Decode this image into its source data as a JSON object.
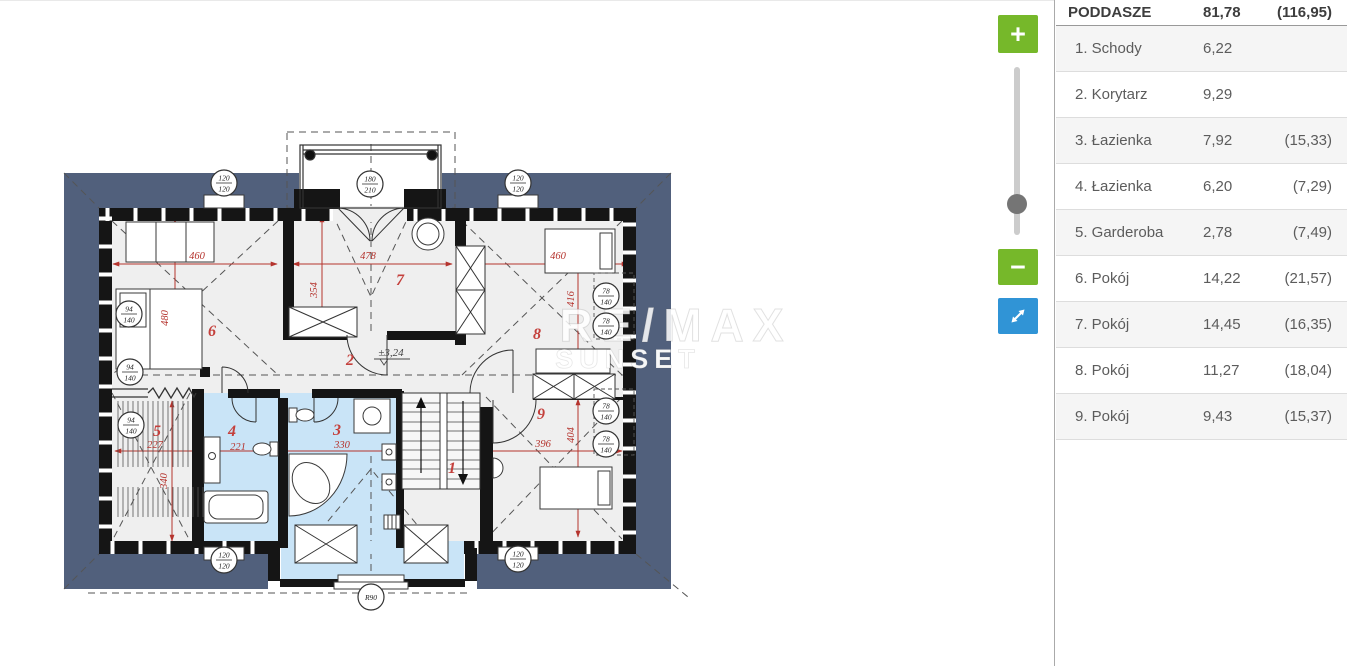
{
  "colors": {
    "roof_band": "#51607c",
    "bath_highlight": "#c9e4f7",
    "dimension_red": "#b5342e",
    "zoom_button_green": "#76b82a",
    "expand_button_blue": "#3094d6"
  },
  "controls": {
    "zoom_in_label": "+",
    "zoom_out_label": "−"
  },
  "watermark": {
    "line1": "RE/MAX",
    "line2": "SUNSET"
  },
  "panel": {
    "header": {
      "name": "PODDASZE",
      "area": "81,78",
      "total": "(116,95)"
    },
    "rows": [
      {
        "name": "1. Schody",
        "area": "6,22",
        "total": ""
      },
      {
        "name": "2. Korytarz",
        "area": "9,29",
        "total": ""
      },
      {
        "name": "3. Łazienka",
        "area": "7,92",
        "total": "(15,33)"
      },
      {
        "name": "4. Łazienka",
        "area": "6,20",
        "total": "(7,29)"
      },
      {
        "name": "5. Garderoba",
        "area": "2,78",
        "total": "(7,49)"
      },
      {
        "name": "6. Pokój",
        "area": "14,22",
        "total": "(21,57)"
      },
      {
        "name": "7. Pokój",
        "area": "14,45",
        "total": "(16,35)"
      },
      {
        "name": "8. Pokój",
        "area": "11,27",
        "total": "(18,04)"
      },
      {
        "name": "9. Pokój",
        "area": "9,43",
        "total": "(15,37)"
      }
    ]
  },
  "plan": {
    "level_label": "±3,24",
    "room_numbers": [
      {
        "n": "1",
        "x": 452,
        "y": 472
      },
      {
        "n": "2",
        "x": 350,
        "y": 364
      },
      {
        "n": "3",
        "x": 337,
        "y": 434
      },
      {
        "n": "4",
        "x": 232,
        "y": 435
      },
      {
        "n": "5",
        "x": 157,
        "y": 435
      },
      {
        "n": "6",
        "x": 212,
        "y": 335
      },
      {
        "n": "7",
        "x": 400,
        "y": 284
      },
      {
        "n": "8",
        "x": 537,
        "y": 338
      },
      {
        "n": "9",
        "x": 541,
        "y": 418
      }
    ],
    "dim_labels": [
      {
        "t": "460",
        "x": 197,
        "y": 258
      },
      {
        "t": "478",
        "x": 368,
        "y": 258
      },
      {
        "t": "460",
        "x": 558,
        "y": 258
      },
      {
        "t": "480",
        "x": 168,
        "y": 317,
        "rot": -90
      },
      {
        "t": "354",
        "x": 317,
        "y": 289,
        "rot": -90
      },
      {
        "t": "416",
        "x": 574,
        "y": 298,
        "rot": -90
      },
      {
        "t": "404",
        "x": 574,
        "y": 434,
        "rot": -90
      },
      {
        "t": "340",
        "x": 167,
        "y": 480,
        "rot": -90
      },
      {
        "t": "227",
        "x": 155,
        "y": 447
      },
      {
        "t": "221",
        "x": 238,
        "y": 449
      },
      {
        "t": "330",
        "x": 342,
        "y": 447
      },
      {
        "t": "396",
        "x": 543,
        "y": 446
      }
    ],
    "circle_labels": [
      {
        "top": "120",
        "bot": "120",
        "x": 224,
        "y": 182
      },
      {
        "top": "180",
        "bot": "210",
        "x": 370,
        "y": 183
      },
      {
        "top": "120",
        "bot": "120",
        "x": 518,
        "y": 182
      },
      {
        "top": "94",
        "bot": "140",
        "x": 129,
        "y": 313
      },
      {
        "top": "94",
        "bot": "140",
        "x": 130,
        "y": 371
      },
      {
        "top": "94",
        "bot": "140",
        "x": 131,
        "y": 424
      },
      {
        "top": "78",
        "bot": "140",
        "x": 606,
        "y": 295
      },
      {
        "top": "78",
        "bot": "140",
        "x": 606,
        "y": 325
      },
      {
        "top": "78",
        "bot": "140",
        "x": 606,
        "y": 410
      },
      {
        "top": "78",
        "bot": "140",
        "x": 606,
        "y": 443
      },
      {
        "top": "120",
        "bot": "120",
        "x": 224,
        "y": 559
      },
      {
        "top": "120",
        "bot": "120",
        "x": 518,
        "y": 558
      },
      {
        "single": "R90",
        "x": 371,
        "y": 596
      }
    ]
  }
}
